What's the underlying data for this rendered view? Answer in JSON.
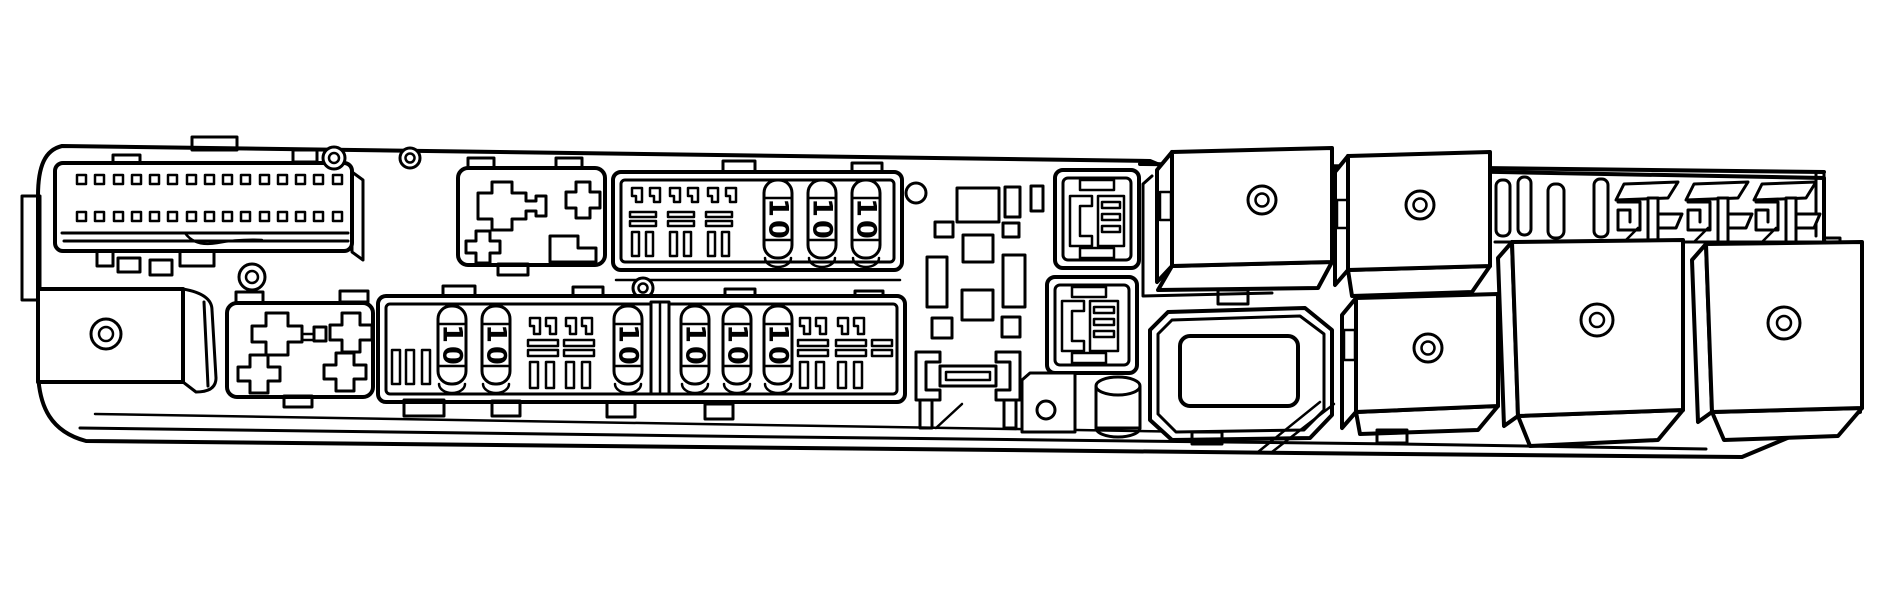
{
  "figure": {
    "kind": "black-and-white technical line illustration",
    "subject": "automotive fuse and relay box, angled top view",
    "colors": {
      "background": "#ffffff",
      "line": "#000000"
    },
    "top_fuse_bank": {
      "fuses": [
        "10",
        "10",
        "10"
      ],
      "empty_slot_groups": 3
    },
    "bottom_fuse_bank": {
      "fuses": [
        "10",
        "10",
        "10",
        "10",
        "10",
        "10"
      ],
      "empty_slot_groups": 5
    },
    "pin_connector": {
      "rows": 2,
      "pins_per_row": 15
    },
    "marks": {
      "screw_head_marks": 4,
      "relay_cover_marks": 6,
      "plain_holes": 2
    }
  }
}
